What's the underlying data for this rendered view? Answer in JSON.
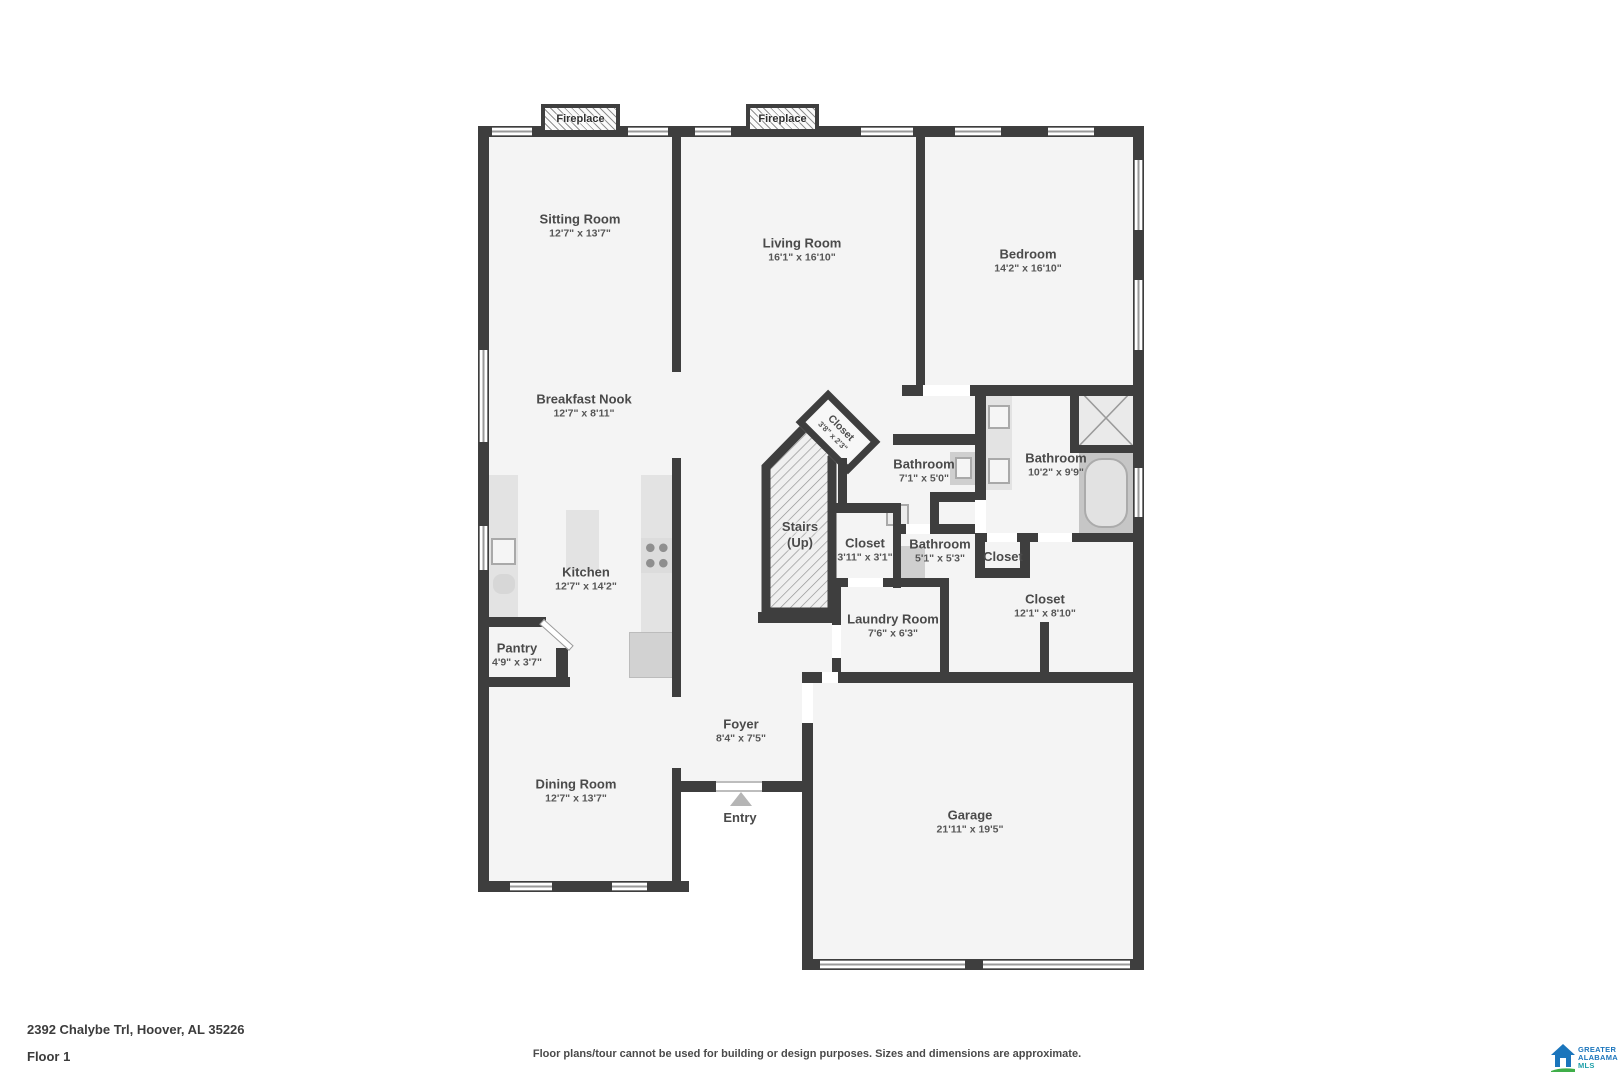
{
  "address": "2392 Chalybe Trl, Hoover, AL 35226",
  "floor_label": "Floor 1",
  "disclaimer": "Floor plans/tour cannot be used for building or design purposes. Sizes and dimensions are approximate.",
  "fireplace_label": "Fireplace",
  "logo": {
    "line1": "GREATER",
    "line2": "ALABAMA",
    "line3": "MLS"
  },
  "colors": {
    "wall": "#3e3e3e",
    "floor": "#f4f4f4",
    "label": "#4a4a4a",
    "logo_blue": "#1b75bc",
    "logo_green": "#3fae49",
    "logo_teal": "#1d9fa8"
  },
  "rooms": [
    {
      "id": "sitting-room",
      "name": "Sitting Room",
      "dims": "12'7\" x 13'7\"",
      "x": 580,
      "y": 226
    },
    {
      "id": "living-room",
      "name": "Living Room",
      "dims": "16'1\" x 16'10\"",
      "x": 802,
      "y": 250
    },
    {
      "id": "bedroom",
      "name": "Bedroom",
      "dims": "14'2\" x 16'10\"",
      "x": 1028,
      "y": 261
    },
    {
      "id": "breakfast-nook",
      "name": "Breakfast Nook",
      "dims": "12'7\" x 8'11\"",
      "x": 584,
      "y": 406
    },
    {
      "id": "kitchen",
      "name": "Kitchen",
      "dims": "12'7\" x 14'2\"",
      "x": 586,
      "y": 579
    },
    {
      "id": "pantry",
      "name": "Pantry",
      "dims": "4'9\" x 3'7\"",
      "x": 517,
      "y": 655
    },
    {
      "id": "dining-room",
      "name": "Dining Room",
      "dims": "12'7\" x 13'7\"",
      "x": 576,
      "y": 791
    },
    {
      "id": "foyer",
      "name": "Foyer",
      "dims": "8'4\" x 7'5\"",
      "x": 741,
      "y": 731
    },
    {
      "id": "entry",
      "name": "Entry",
      "x": 740,
      "y": 818
    },
    {
      "id": "stairs",
      "name": "Stairs",
      "dims": "(Up)",
      "dims_bold": true,
      "halo": true,
      "x": 800,
      "y": 535
    },
    {
      "id": "closet-angled",
      "name": "Closet",
      "dims": "3'8\" x 2'3\"",
      "rotate": 45,
      "small": true,
      "x": 837,
      "y": 432
    },
    {
      "id": "bathroom-hall",
      "name": "Bathroom",
      "dims": "7'1\" x 5'0\"",
      "x": 924,
      "y": 471
    },
    {
      "id": "bathroom-master",
      "name": "Bathroom",
      "dims": "10'2\" x 9'9\"",
      "x": 1056,
      "y": 465
    },
    {
      "id": "closet-hall",
      "name": "Closet",
      "dims": "3'11\" x 3'1\"",
      "x": 865,
      "y": 550
    },
    {
      "id": "bathroom-half",
      "name": "Bathroom",
      "dims": "5'1\" x 5'3\"",
      "x": 940,
      "y": 551
    },
    {
      "id": "closet-small",
      "name": "Closet",
      "x": 1003,
      "y": 557
    },
    {
      "id": "closet-large",
      "name": "Closet",
      "dims": "12'1\" x 8'10\"",
      "x": 1045,
      "y": 606
    },
    {
      "id": "laundry-room",
      "name": "Laundry Room",
      "dims": "7'6\" x 6'3\"",
      "x": 893,
      "y": 626
    },
    {
      "id": "garage",
      "name": "Garage",
      "dims": "21'11\" x 19'5\"",
      "x": 970,
      "y": 822
    }
  ]
}
